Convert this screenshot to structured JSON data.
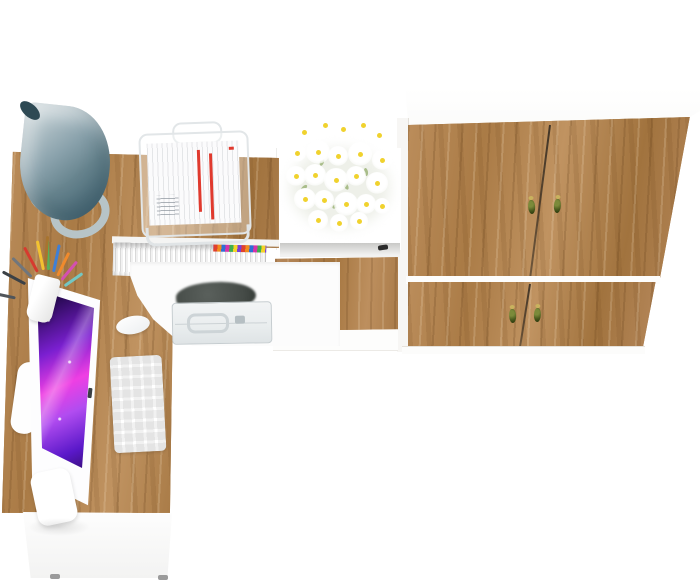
{
  "meta": {
    "type": "product-photo",
    "subject": "Top view of a white and oak home-office set: corner desk with hutch, drawer unit and two-door wardrobe",
    "visible_text": "none"
  },
  "colors": {
    "floor-white": "#ffffff",
    "wood-base": "#b1834f",
    "wood-dark": "#7a5222",
    "wood-light": "#cfa06a",
    "panel-line": "#e6e2db",
    "lamp-light": "#c6d2d6",
    "lamp-mid": "#8aa2ac",
    "lamp-dark": "#4f6f7d",
    "lamp-tip": "#2e4a54",
    "metal-gray": "#b7c4c7",
    "handle-olive": "#4a5a1e",
    "handle-brass": "#c9b25e",
    "screen-deep": "#2a0a57",
    "screen-violet": "#7a1fd0",
    "screen-magenta": "#ef3fe3",
    "briefcase-gray": "#e9edee",
    "bag-dark": "#454b47",
    "daisy-center": "#f0d22e",
    "leaf-green": "#a9bd8a",
    "paper-red": "#e03a2e",
    "tab-1": "#e0412e",
    "tab-2": "#f08c1e",
    "tab-3": "#2e6fd6",
    "tab-4": "#d633a8",
    "tab-5": "#3faf4f",
    "tab-6": "#f5d327",
    "tab-7": "#7a3fd6"
  },
  "objects": {
    "scene": "White and oak office furniture set, viewed from above",
    "wardrobe": "Wardrobe with four oak door fronts and olive drop handles",
    "wardrobe_top": "White wardrobe top panel",
    "desk": "Corner desk with oak worktop",
    "hutch": "Desk hutch shelf in oak",
    "drawer": "Drawer with oak front and olive handle",
    "pedestal": "White desk pedestal",
    "monitor": "All-in-one computer with purple galaxy wallpaper",
    "keyboard": "White wireless keyboard",
    "mouse": "White computer mouse",
    "lamp": "Grey cone desk lamp",
    "pencil_cup": "White cup with coloured pens and pencils",
    "basket": "White wire document basket with papers",
    "magazines": "Row of magazines with coloured page tabs",
    "briefcase": "Light grey briefcase on lower shelf",
    "bag": "Dark bag on lower shelf",
    "flowers": "Bouquet of white daisies on the shelf"
  }
}
